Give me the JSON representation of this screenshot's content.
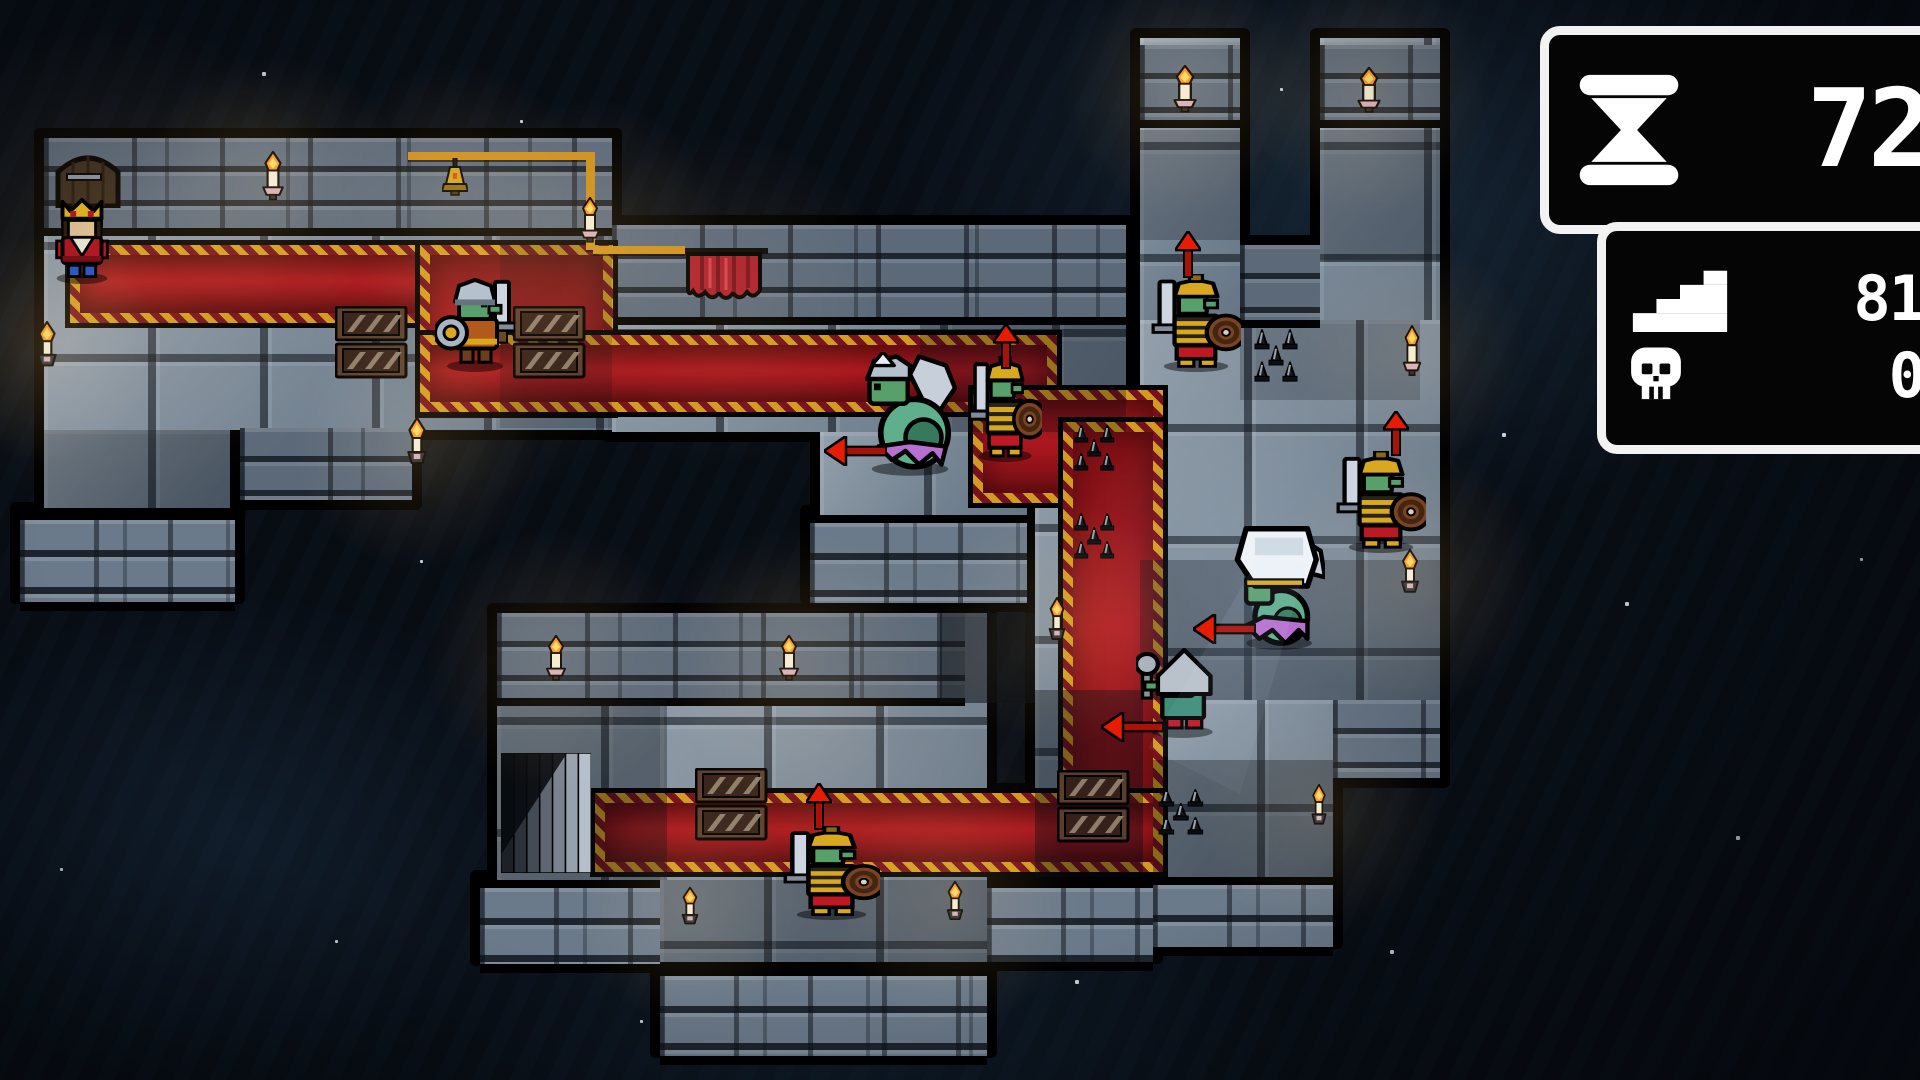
{
  "hud": {
    "turns": "72",
    "steps": "81",
    "kills": "0"
  },
  "palette": {
    "outline": "#000000",
    "floor": "#82909e",
    "brick": "#5b6979",
    "carpet_red": "#a6151c",
    "carpet_gold": "#d29a1e",
    "arrow_red": "#e81c04",
    "flame_orange": "#ff9020",
    "candle": "#f4ead0",
    "goblin_green": "#58a06b",
    "serpent_green": "#5fae8c",
    "frill_purple": "#b86fd2",
    "armor_gold": "#d9a81f",
    "hud_border": "#f2f2f2",
    "hud_bg": "#050505"
  },
  "map": {
    "floors": [
      {
        "r": [
          44,
          138,
          568,
          292
        ]
      },
      {
        "r": [
          44,
          430,
          186,
          78
        ]
      },
      {
        "r": [
          612,
          225,
          514,
          207
        ]
      },
      {
        "r": [
          820,
          432,
          207,
          83
        ]
      },
      {
        "r": [
          1140,
          38,
          100,
          300
        ]
      },
      {
        "r": [
          1320,
          38,
          120,
          300
        ]
      },
      {
        "r": [
          1140,
          320,
          300,
          380
        ]
      },
      {
        "r": [
          1153,
          700,
          180,
          177
        ]
      },
      {
        "r": [
          497,
          613,
          468,
          267
        ]
      },
      {
        "r": [
          660,
          613,
          327,
          349
        ]
      },
      {
        "r": [
          1035,
          420,
          108,
          457
        ]
      }
    ],
    "walls": [
      {
        "r": [
          44,
          138,
          568,
          90
        ]
      },
      {
        "r": [
          612,
          225,
          514,
          92
        ]
      },
      {
        "r": [
          1140,
          45,
          100,
          75
        ]
      },
      {
        "r": [
          1320,
          45,
          120,
          75
        ]
      },
      {
        "r": [
          1240,
          245,
          80,
          75
        ]
      },
      {
        "r": [
          240,
          428,
          172,
          72
        ]
      },
      {
        "r": [
          497,
          613,
          468,
          85
        ]
      },
      {
        "r": [
          1333,
          700,
          107,
          78
        ]
      }
    ],
    "skirts": [
      {
        "r": [
          20,
          512,
          215,
          82
        ]
      },
      {
        "r": [
          810,
          515,
          217,
          80
        ]
      },
      {
        "r": [
          480,
          880,
          180,
          76
        ]
      },
      {
        "r": [
          660,
          968,
          327,
          80
        ]
      },
      {
        "r": [
          987,
          880,
          166,
          74
        ]
      },
      {
        "r": [
          1153,
          877,
          180,
          62
        ]
      }
    ],
    "extra_black": [
      [
        600,
        225,
        14,
        88
      ]
    ],
    "carpets": [
      {
        "r": [
          70,
          245,
          523,
          58
        ]
      },
      {
        "r": [
          420,
          245,
          173,
          148
        ]
      },
      {
        "r": [
          420,
          335,
          617,
          57
        ]
      },
      {
        "r": [
          973,
          390,
          170,
          93
        ]
      },
      {
        "r": [
          1063,
          422,
          80,
          433
        ]
      },
      {
        "r": [
          595,
          793,
          548,
          59
        ]
      }
    ],
    "shades": [
      {
        "r": [
          44,
          430,
          186,
          78
        ],
        "a": 0.3
      },
      {
        "r": [
          500,
          232,
          112,
          196
        ],
        "a": 0.18
      },
      {
        "r": [
          920,
          320,
          206,
          112
        ],
        "a": 0.28
      },
      {
        "r": [
          940,
          613,
          95,
          90
        ],
        "a": 0.55
      },
      {
        "r": [
          497,
          700,
          170,
          180
        ],
        "a": 0.35
      },
      {
        "r": [
          660,
          880,
          327,
          82
        ],
        "a": 0.28
      },
      {
        "r": [
          1035,
          690,
          108,
          187
        ],
        "a": 0.4
      },
      {
        "r": [
          1153,
          760,
          180,
          117
        ],
        "a": 0.35
      },
      {
        "r": [
          1140,
          560,
          300,
          140
        ],
        "a": 0.3
      },
      {
        "r": [
          1240,
          320,
          180,
          80
        ],
        "a": 0.22
      },
      {
        "r": [
          1140,
          130,
          100,
          110
        ],
        "a": 0.25
      },
      {
        "r": [
          1320,
          130,
          120,
          130
        ],
        "a": 0.28
      }
    ],
    "props": [
      {
        "type": "door",
        "r": [
          55,
          150,
          66,
          58
        ],
        "name": "door"
      },
      {
        "type": "stairs",
        "r": [
          501,
          753,
          90,
          120
        ],
        "name": "stairs-exit"
      },
      {
        "type": "curtain",
        "r": [
          680,
          246,
          88,
          64
        ],
        "name": "curtain-banner"
      },
      {
        "type": "wire",
        "r": [
          408,
          152,
          187,
          8
        ],
        "name": "gold-wire"
      },
      {
        "type": "wire",
        "r": [
          586,
          158,
          9,
          92
        ],
        "name": "gold-wire"
      },
      {
        "type": "wire",
        "r": [
          593,
          246,
          92,
          8
        ],
        "name": "gold-wire"
      },
      {
        "type": "lamp",
        "r": [
          442,
          158,
          26,
          50
        ],
        "name": "hanging-lamp"
      },
      {
        "type": "crates",
        "r": [
          335,
          306,
          73,
          73
        ],
        "name": "crates"
      },
      {
        "type": "crates",
        "r": [
          513,
          306,
          73,
          73
        ],
        "name": "crates"
      },
      {
        "type": "crates",
        "r": [
          1057,
          770,
          73,
          73
        ],
        "name": "crates"
      },
      {
        "type": "crates",
        "r": [
          695,
          768,
          73,
          73
        ],
        "name": "crates"
      },
      {
        "type": "spikes",
        "r": [
          1071,
          424,
          52,
          52
        ],
        "name": "spike-trap"
      },
      {
        "type": "spikes",
        "r": [
          1071,
          512,
          52,
          52
        ],
        "name": "spike-trap"
      },
      {
        "type": "spikes",
        "r": [
          1251,
          328,
          56,
          60
        ],
        "name": "spike-trap"
      },
      {
        "type": "spikes",
        "r": [
          1155,
          788,
          58,
          52
        ],
        "name": "spike-trap"
      }
    ],
    "lights": [
      {
        "type": "candle",
        "r": [
          260,
          150,
          26,
          56
        ]
      },
      {
        "type": "torch",
        "r": [
          34,
          320,
          26,
          58
        ]
      },
      {
        "type": "torch",
        "r": [
          404,
          416,
          26,
          60
        ]
      },
      {
        "type": "candle",
        "r": [
          578,
          196,
          24,
          52
        ]
      },
      {
        "type": "candle",
        "r": [
          1171,
          64,
          28,
          54
        ]
      },
      {
        "type": "candle",
        "r": [
          1355,
          66,
          28,
          52
        ]
      },
      {
        "type": "candle",
        "r": [
          1401,
          324,
          22,
          58
        ]
      },
      {
        "type": "torch",
        "r": [
          1398,
          548,
          24,
          56
        ]
      },
      {
        "type": "torch",
        "r": [
          1309,
          783,
          20,
          52
        ]
      },
      {
        "type": "candle",
        "r": [
          544,
          634,
          24,
          52
        ]
      },
      {
        "type": "candle",
        "r": [
          777,
          634,
          24,
          52
        ]
      },
      {
        "type": "torch",
        "r": [
          679,
          886,
          22,
          48
        ]
      },
      {
        "type": "torch",
        "r": [
          944,
          880,
          22,
          50
        ]
      },
      {
        "type": "torch",
        "r": [
          1046,
          596,
          22,
          55
        ]
      }
    ],
    "entities": [
      {
        "type": "king",
        "r": [
          45,
          198,
          74,
          86
        ],
        "name": "entity-king"
      },
      {
        "type": "goblin",
        "r": [
          435,
          274,
          80,
          98
        ],
        "name": "entity-goblin-soldier"
      },
      {
        "type": "naga",
        "r": [
          856,
          352,
          108,
          126
        ],
        "name": "entity-serpent-axe"
      },
      {
        "type": "armored",
        "r": [
          968,
          356,
          74,
          106
        ],
        "name": "entity-armored-goblin"
      },
      {
        "type": "armored",
        "r": [
          1151,
          274,
          90,
          98
        ],
        "name": "entity-armored-goblin"
      },
      {
        "type": "armored",
        "r": [
          1336,
          451,
          90,
          102
        ],
        "name": "entity-armored-goblin"
      },
      {
        "type": "white_naga",
        "r": [
          1233,
          520,
          92,
          132
        ],
        "name": "entity-hooded-serpent"
      },
      {
        "type": "hooded",
        "r": [
          1136,
          646,
          92,
          92
        ],
        "name": "entity-hooded-goblin"
      },
      {
        "type": "armored",
        "r": [
          783,
          826,
          97,
          94
        ],
        "name": "entity-armored-goblin"
      }
    ],
    "arrows": [
      {
        "dir": "left",
        "r": [
          824,
          436,
          64,
          30
        ]
      },
      {
        "dir": "up",
        "r": [
          993,
          324,
          26,
          46
        ]
      },
      {
        "dir": "up",
        "r": [
          1175,
          231,
          26,
          48
        ]
      },
      {
        "dir": "up",
        "r": [
          1383,
          411,
          26,
          46
        ]
      },
      {
        "dir": "left",
        "r": [
          1193,
          614,
          64,
          30
        ]
      },
      {
        "dir": "left",
        "r": [
          1101,
          712,
          64,
          30
        ]
      },
      {
        "dir": "up",
        "r": [
          806,
          783,
          26,
          48
        ]
      }
    ],
    "glows": [
      {
        "x": 115,
        "y": 265,
        "rad": 280,
        "a": 0.12,
        "kind": "warm"
      },
      {
        "x": 272,
        "y": 185,
        "rad": 150,
        "a": 0.14,
        "kind": "warm"
      },
      {
        "x": 455,
        "y": 195,
        "rad": 150,
        "a": 0.12,
        "kind": "warm"
      },
      {
        "x": 590,
        "y": 230,
        "rad": 150,
        "a": 0.13,
        "kind": "warm"
      },
      {
        "x": 470,
        "y": 320,
        "rad": 210,
        "a": 0.1,
        "kind": "warm"
      },
      {
        "x": 47,
        "y": 348,
        "rad": 130,
        "a": 0.14,
        "kind": "warm"
      },
      {
        "x": 417,
        "y": 446,
        "rad": 140,
        "a": 0.13,
        "kind": "warm"
      },
      {
        "x": 725,
        "y": 300,
        "rad": 190,
        "a": 0.09,
        "kind": "warm"
      },
      {
        "x": 1185,
        "y": 92,
        "rad": 140,
        "a": 0.14,
        "kind": "warm"
      },
      {
        "x": 1369,
        "y": 92,
        "rad": 140,
        "a": 0.14,
        "kind": "warm"
      },
      {
        "x": 1412,
        "y": 352,
        "rad": 130,
        "a": 0.12,
        "kind": "warm"
      },
      {
        "x": 1410,
        "y": 576,
        "rad": 150,
        "a": 0.13,
        "kind": "warm"
      },
      {
        "x": 1319,
        "y": 809,
        "rad": 140,
        "a": 0.12,
        "kind": "warm"
      },
      {
        "x": 556,
        "y": 660,
        "rad": 150,
        "a": 0.12,
        "kind": "warm"
      },
      {
        "x": 789,
        "y": 660,
        "rad": 150,
        "a": 0.12,
        "kind": "warm"
      },
      {
        "x": 690,
        "y": 910,
        "rad": 130,
        "a": 0.13,
        "kind": "warm"
      },
      {
        "x": 955,
        "y": 905,
        "rad": 140,
        "a": 0.13,
        "kind": "warm"
      },
      {
        "x": 1057,
        "y": 622,
        "rad": 140,
        "a": 0.13,
        "kind": "warm"
      },
      {
        "x": 845,
        "y": 770,
        "rad": 260,
        "a": 0.08,
        "kind": "warm"
      },
      {
        "x": 1265,
        "y": 590,
        "rad": 230,
        "a": 0.14,
        "kind": "cool"
      }
    ],
    "specks": [
      [
        262,
        72,
        4
      ],
      [
        520,
        120,
        3
      ],
      [
        150,
        418,
        3
      ],
      [
        228,
        432,
        4
      ],
      [
        916,
        683,
        4
      ],
      [
        1008,
        500,
        4
      ],
      [
        737,
        432,
        3
      ],
      [
        420,
        560,
        3
      ],
      [
        60,
        868,
        3
      ],
      [
        1075,
        980,
        4
      ],
      [
        1502,
        433,
        4
      ],
      [
        1625,
        602,
        4
      ],
      [
        1736,
        836,
        4
      ],
      [
        1860,
        558,
        3
      ],
      [
        1280,
        88,
        3
      ],
      [
        640,
        1020,
        3
      ],
      [
        335,
        940,
        3
      ],
      [
        1390,
        950,
        4
      ]
    ]
  }
}
